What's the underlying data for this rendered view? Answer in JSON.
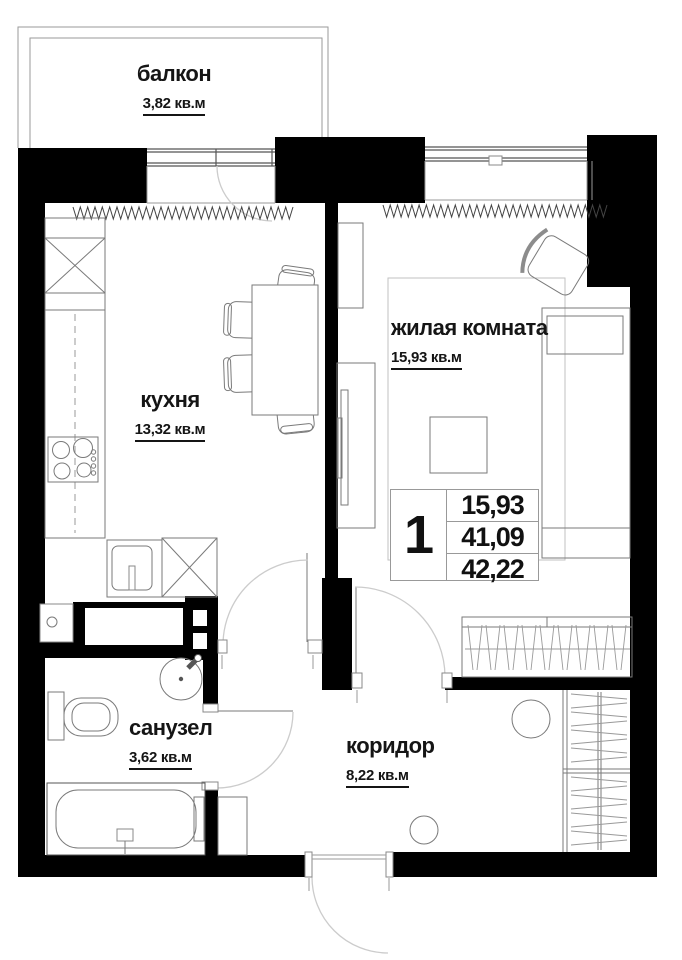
{
  "rooms": [
    {
      "id": "balcony",
      "name": "балкон",
      "area": "3,82 кв.м"
    },
    {
      "id": "kitchen",
      "name": "кухня",
      "area": "13,32 кв.м"
    },
    {
      "id": "living-room",
      "name": "жилая комната",
      "area": "15,93 кв.м"
    },
    {
      "id": "bathroom",
      "name": "санузел",
      "area": "3,62 кв.м"
    },
    {
      "id": "corridor",
      "name": "коридор",
      "area": "8,22 кв.м"
    }
  ],
  "info_table": {
    "rooms_count": "1",
    "values": [
      "15,93",
      "41,09",
      "42,22"
    ]
  },
  "colors": {
    "wall": "#000000",
    "furniture_line": "#7a7a7a",
    "arc_line": "#cccccc",
    "text": "#151515",
    "background": "#ffffff"
  }
}
